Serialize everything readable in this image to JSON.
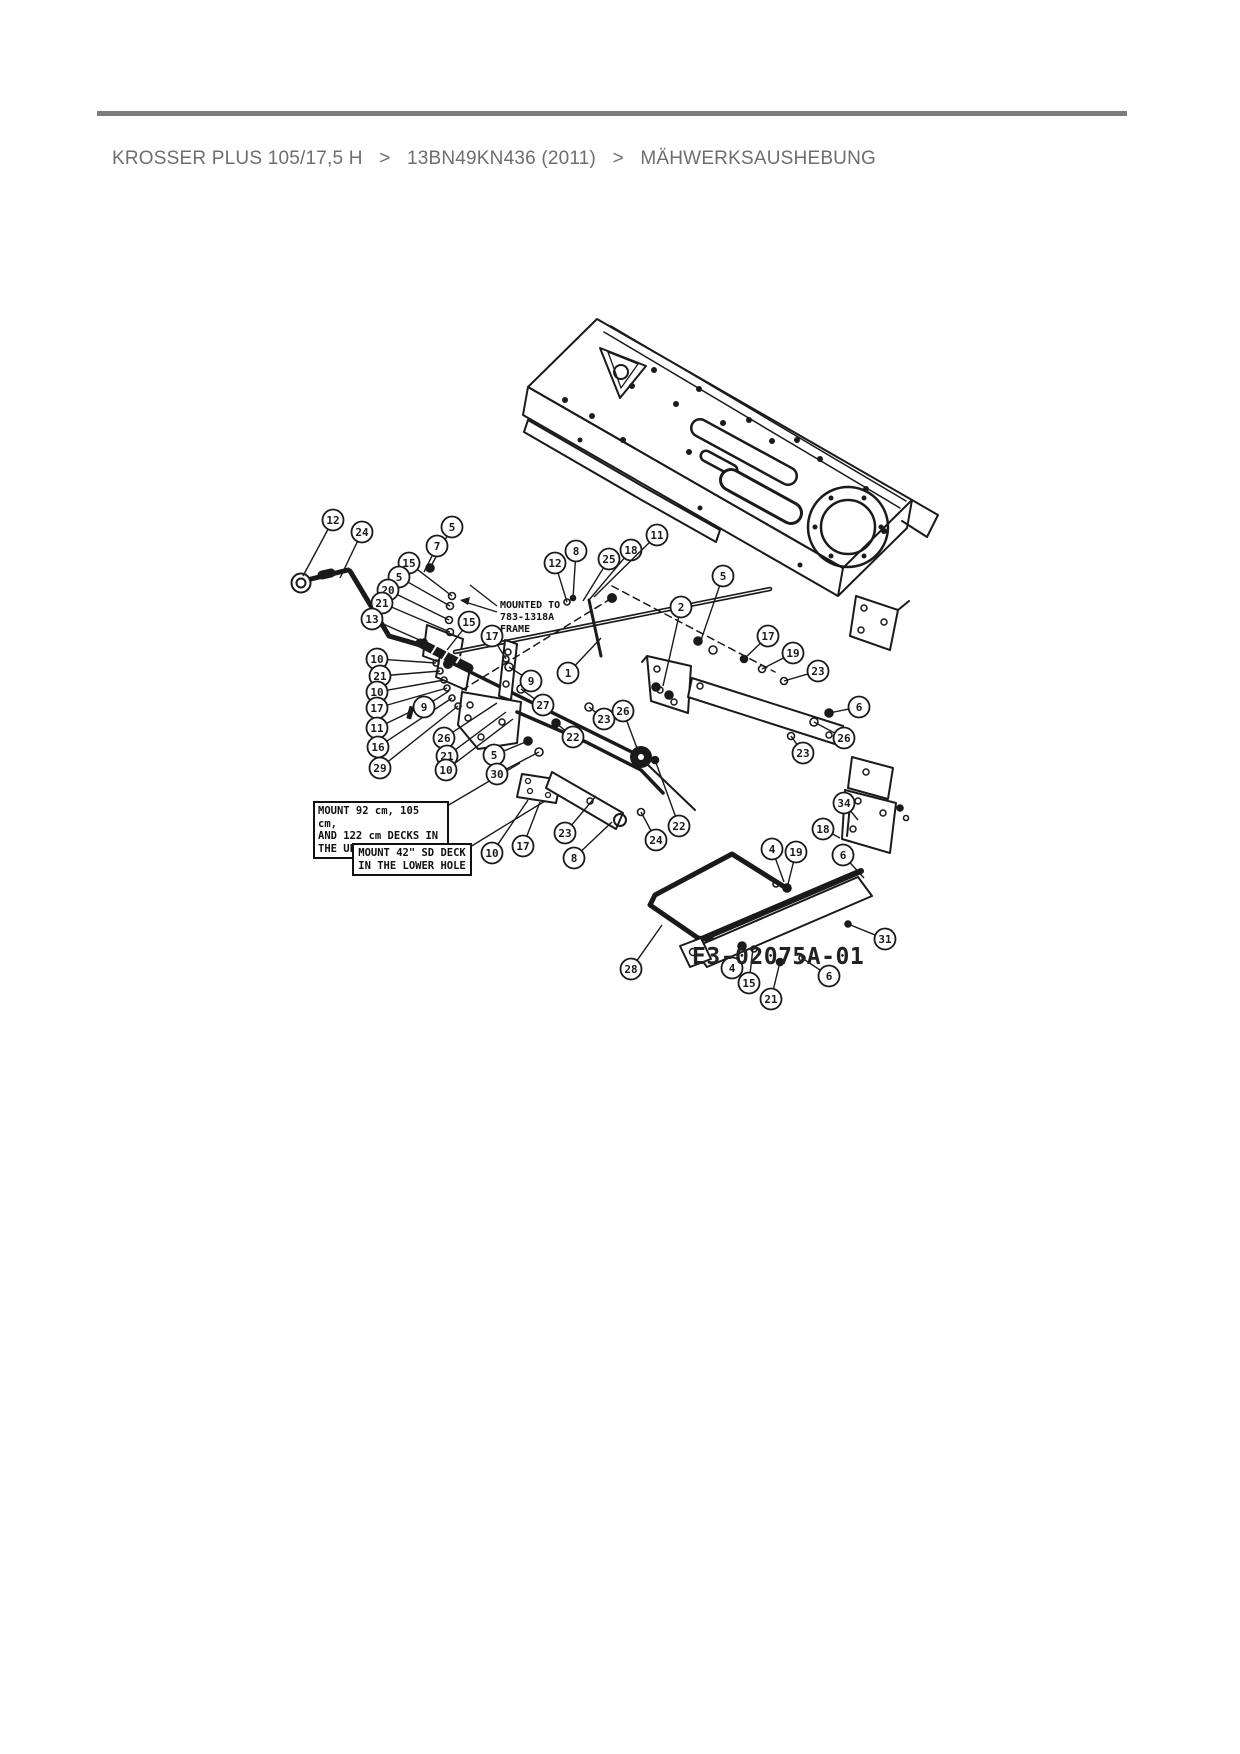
{
  "page": {
    "background": "#ffffff",
    "rule_color": "#7c7c7c"
  },
  "breadcrumb": {
    "separator": ">",
    "items": [
      "KROSSER PLUS 105/17,5 H",
      "13BN49KN436 (2011)",
      "MÄHWERKSAUSHEBUNG"
    ],
    "text_color": "#6e6e6e"
  },
  "diagram": {
    "code_label": "E3-02075A-01",
    "notes": {
      "mounted_note": "MOUNTED TO\n783-1318A\nFRAME",
      "upper_hole_box": "MOUNT 92 cm, 105 cm,\nAND 122 cm DECKS IN\nTHE UPPER HOLE",
      "lower_hole_box": "MOUNT 42\" SD DECK\nIN THE LOWER HOLE"
    },
    "line_color": "#1a1a1a",
    "callouts": [
      {
        "n": "12",
        "x": 333,
        "y": 520,
        "tx": 303,
        "ty": 576
      },
      {
        "n": "24",
        "x": 362,
        "y": 532,
        "tx": 340,
        "ty": 578
      },
      {
        "n": "5",
        "x": 452,
        "y": 527,
        "tx": 430,
        "ty": 568
      },
      {
        "n": "7",
        "x": 437,
        "y": 546,
        "tx": 424,
        "ty": 572
      },
      {
        "n": "15",
        "x": 409,
        "y": 563,
        "tx": 452,
        "ty": 596
      },
      {
        "n": "5",
        "x": 399,
        "y": 577,
        "tx": 450,
        "ty": 606
      },
      {
        "n": "20",
        "x": 388,
        "y": 590,
        "tx": 449,
        "ty": 620
      },
      {
        "n": "21",
        "x": 382,
        "y": 603,
        "tx": 450,
        "ty": 632
      },
      {
        "n": "13",
        "x": 372,
        "y": 619,
        "tx": 424,
        "ty": 642
      },
      {
        "n": "15",
        "x": 469,
        "y": 622,
        "tx": 447,
        "ty": 650
      },
      {
        "n": "17",
        "x": 492,
        "y": 636,
        "tx": 506,
        "ty": 659
      },
      {
        "n": "10",
        "x": 377,
        "y": 659,
        "tx": 436,
        "ty": 663
      },
      {
        "n": "21",
        "x": 380,
        "y": 676,
        "tx": 440,
        "ty": 671
      },
      {
        "n": "10",
        "x": 377,
        "y": 692,
        "tx": 444,
        "ty": 680
      },
      {
        "n": "17",
        "x": 377,
        "y": 708,
        "tx": 447,
        "ty": 688
      },
      {
        "n": "11",
        "x": 377,
        "y": 728,
        "tx": 410,
        "ty": 712
      },
      {
        "n": "16",
        "x": 378,
        "y": 747,
        "tx": 452,
        "ty": 698
      },
      {
        "n": "29",
        "x": 380,
        "y": 768,
        "tx": 458,
        "ty": 706
      },
      {
        "n": "9",
        "x": 424,
        "y": 707,
        "tx": 449,
        "ty": 691
      },
      {
        "n": "1",
        "x": 568,
        "y": 673,
        "tx": 601,
        "ty": 638
      },
      {
        "n": "9",
        "x": 531,
        "y": 681,
        "tx": 509,
        "ty": 667
      },
      {
        "n": "27",
        "x": 543,
        "y": 705,
        "tx": 521,
        "ty": 689
      },
      {
        "n": "26",
        "x": 444,
        "y": 738,
        "tx": 497,
        "ty": 703
      },
      {
        "n": "21",
        "x": 447,
        "y": 756,
        "tx": 506,
        "ty": 712
      },
      {
        "n": "10",
        "x": 446,
        "y": 770,
        "tx": 513,
        "ty": 719
      },
      {
        "n": "5",
        "x": 494,
        "y": 755,
        "tx": 528,
        "ty": 741
      },
      {
        "n": "30",
        "x": 497,
        "y": 774,
        "tx": 539,
        "ty": 752
      },
      {
        "n": "22",
        "x": 573,
        "y": 737,
        "tx": 556,
        "ty": 723
      },
      {
        "n": "23",
        "x": 604,
        "y": 719,
        "tx": 589,
        "ty": 707
      },
      {
        "n": "26",
        "x": 623,
        "y": 711,
        "tx": 637,
        "ty": 748
      },
      {
        "n": "12",
        "x": 555,
        "y": 563,
        "tx": 567,
        "ty": 602
      },
      {
        "n": "8",
        "x": 576,
        "y": 551,
        "tx": 573,
        "ty": 598
      },
      {
        "n": "25",
        "x": 609,
        "y": 559,
        "tx": 583,
        "ty": 601
      },
      {
        "n": "18",
        "x": 631,
        "y": 550,
        "tx": 589,
        "ty": 600
      },
      {
        "n": "11",
        "x": 657,
        "y": 535,
        "tx": 594,
        "ty": 597
      },
      {
        "n": "5",
        "x": 723,
        "y": 576,
        "tx": 700,
        "ty": 643
      },
      {
        "n": "2",
        "x": 681,
        "y": 607,
        "tx": 663,
        "ty": 686
      },
      {
        "n": "17",
        "x": 768,
        "y": 636,
        "tx": 744,
        "ty": 659
      },
      {
        "n": "19",
        "x": 793,
        "y": 653,
        "tx": 762,
        "ty": 669
      },
      {
        "n": "23",
        "x": 818,
        "y": 671,
        "tx": 784,
        "ty": 681
      },
      {
        "n": "6",
        "x": 859,
        "y": 707,
        "tx": 829,
        "ty": 713
      },
      {
        "n": "26",
        "x": 844,
        "y": 738,
        "tx": 814,
        "ty": 722
      },
      {
        "n": "23",
        "x": 803,
        "y": 753,
        "tx": 791,
        "ty": 736
      },
      {
        "n": "22",
        "x": 679,
        "y": 826,
        "tx": 655,
        "ty": 760
      },
      {
        "n": "24",
        "x": 656,
        "y": 840,
        "tx": 641,
        "ty": 812
      },
      {
        "n": "23",
        "x": 565,
        "y": 833,
        "tx": 596,
        "ty": 796
      },
      {
        "n": "8",
        "x": 574,
        "y": 858,
        "tx": 612,
        "ty": 822
      },
      {
        "n": "10",
        "x": 492,
        "y": 853,
        "tx": 528,
        "ty": 800
      },
      {
        "n": "17",
        "x": 523,
        "y": 846,
        "tx": 540,
        "ty": 802
      },
      {
        "n": "4",
        "x": 772,
        "y": 849,
        "tx": 784,
        "ty": 882
      },
      {
        "n": "19",
        "x": 796,
        "y": 852,
        "tx": 788,
        "ty": 884
      },
      {
        "n": "6",
        "x": 843,
        "y": 855,
        "tx": 864,
        "ty": 878
      },
      {
        "n": "34",
        "x": 844,
        "y": 803,
        "tx": 858,
        "ty": 820
      },
      {
        "n": "18",
        "x": 823,
        "y": 829,
        "tx": 840,
        "ty": 838
      },
      {
        "n": "31",
        "x": 885,
        "y": 939,
        "tx": 848,
        "ty": 924
      },
      {
        "n": "28",
        "x": 631,
        "y": 969,
        "tx": 662,
        "ty": 925
      },
      {
        "n": "4",
        "x": 732,
        "y": 968,
        "tx": 742,
        "ty": 946
      },
      {
        "n": "15",
        "x": 749,
        "y": 983,
        "tx": 753,
        "ty": 948
      },
      {
        "n": "21",
        "x": 771,
        "y": 999,
        "tx": 780,
        "ty": 962
      },
      {
        "n": "6",
        "x": 829,
        "y": 976,
        "tx": 802,
        "ty": 958
      }
    ]
  }
}
